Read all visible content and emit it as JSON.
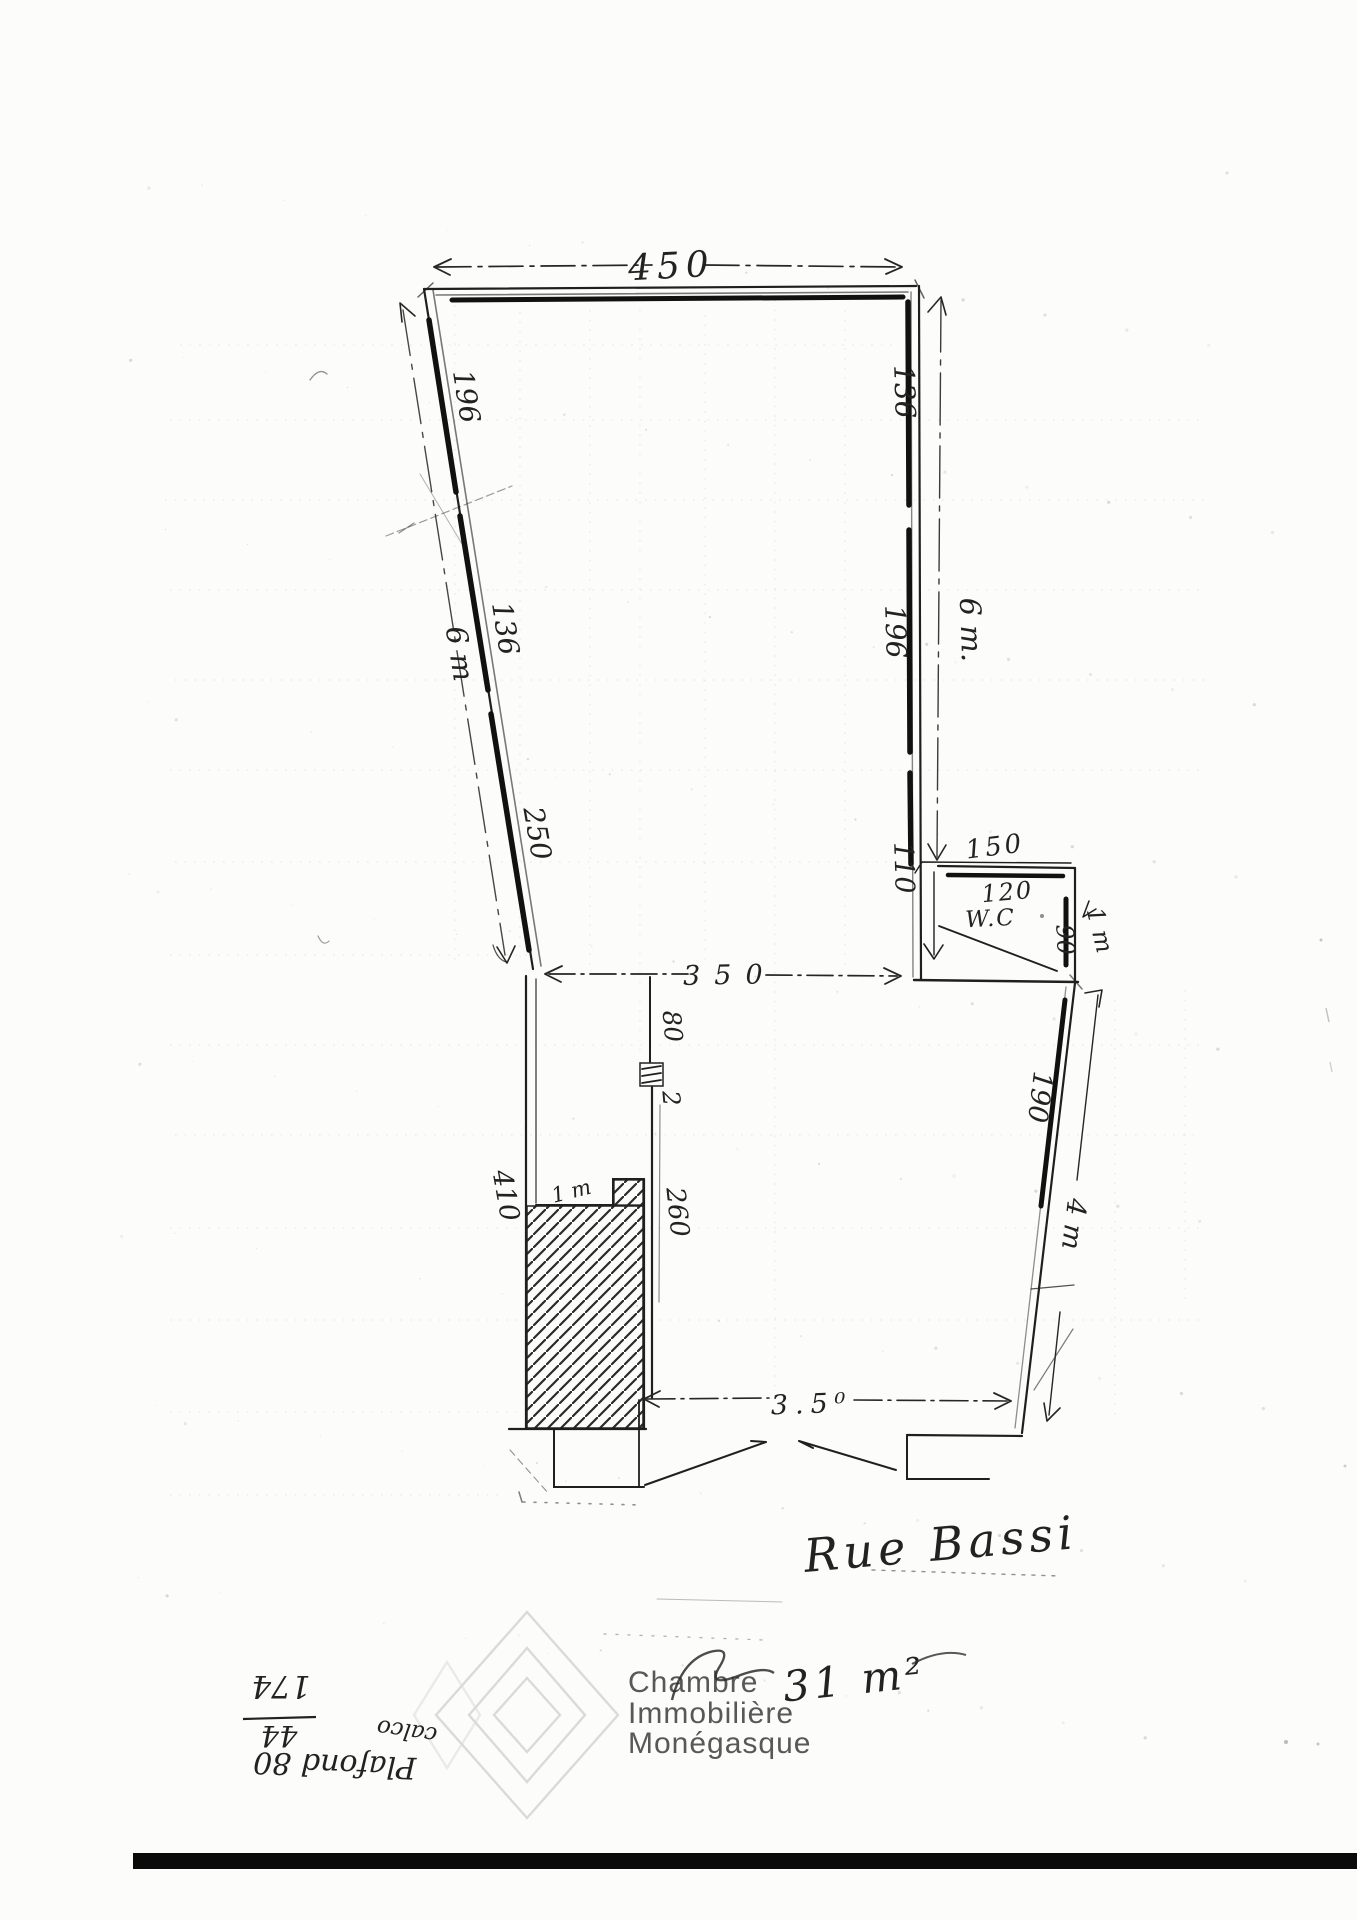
{
  "document": {
    "kind": "hand-drawn floor plan scan",
    "street_label": "Rue Bassi",
    "area_note": "31 m²"
  },
  "dimensions": {
    "top_width": "450",
    "left_wall": {
      "top": "196",
      "middle": "136",
      "bottom": "250",
      "overall": "6 m"
    },
    "right_wall": {
      "top": "136",
      "middle": "196",
      "bottom": "110",
      "overall": "6 m."
    },
    "opening_width": "350",
    "wc": {
      "outer_width": "150",
      "inner_width": "120",
      "label": "W.C",
      "depth": "90",
      "side_height": "1 m"
    },
    "lower_room": {
      "partition": "80",
      "door": "2",
      "inner_wall": "260",
      "step": "1 m",
      "left_height": "410",
      "right_upper": "190",
      "right_overall": "4 m",
      "front_width": "3.5⁰"
    }
  },
  "upside_down_notes": {
    "fraction_over": "44",
    "fraction_under": "174",
    "word": "calco",
    "line": "Plafond 80"
  },
  "watermark": {
    "line1": "Chambre",
    "line2": "Immobilière",
    "line3": "Monégasque"
  }
}
